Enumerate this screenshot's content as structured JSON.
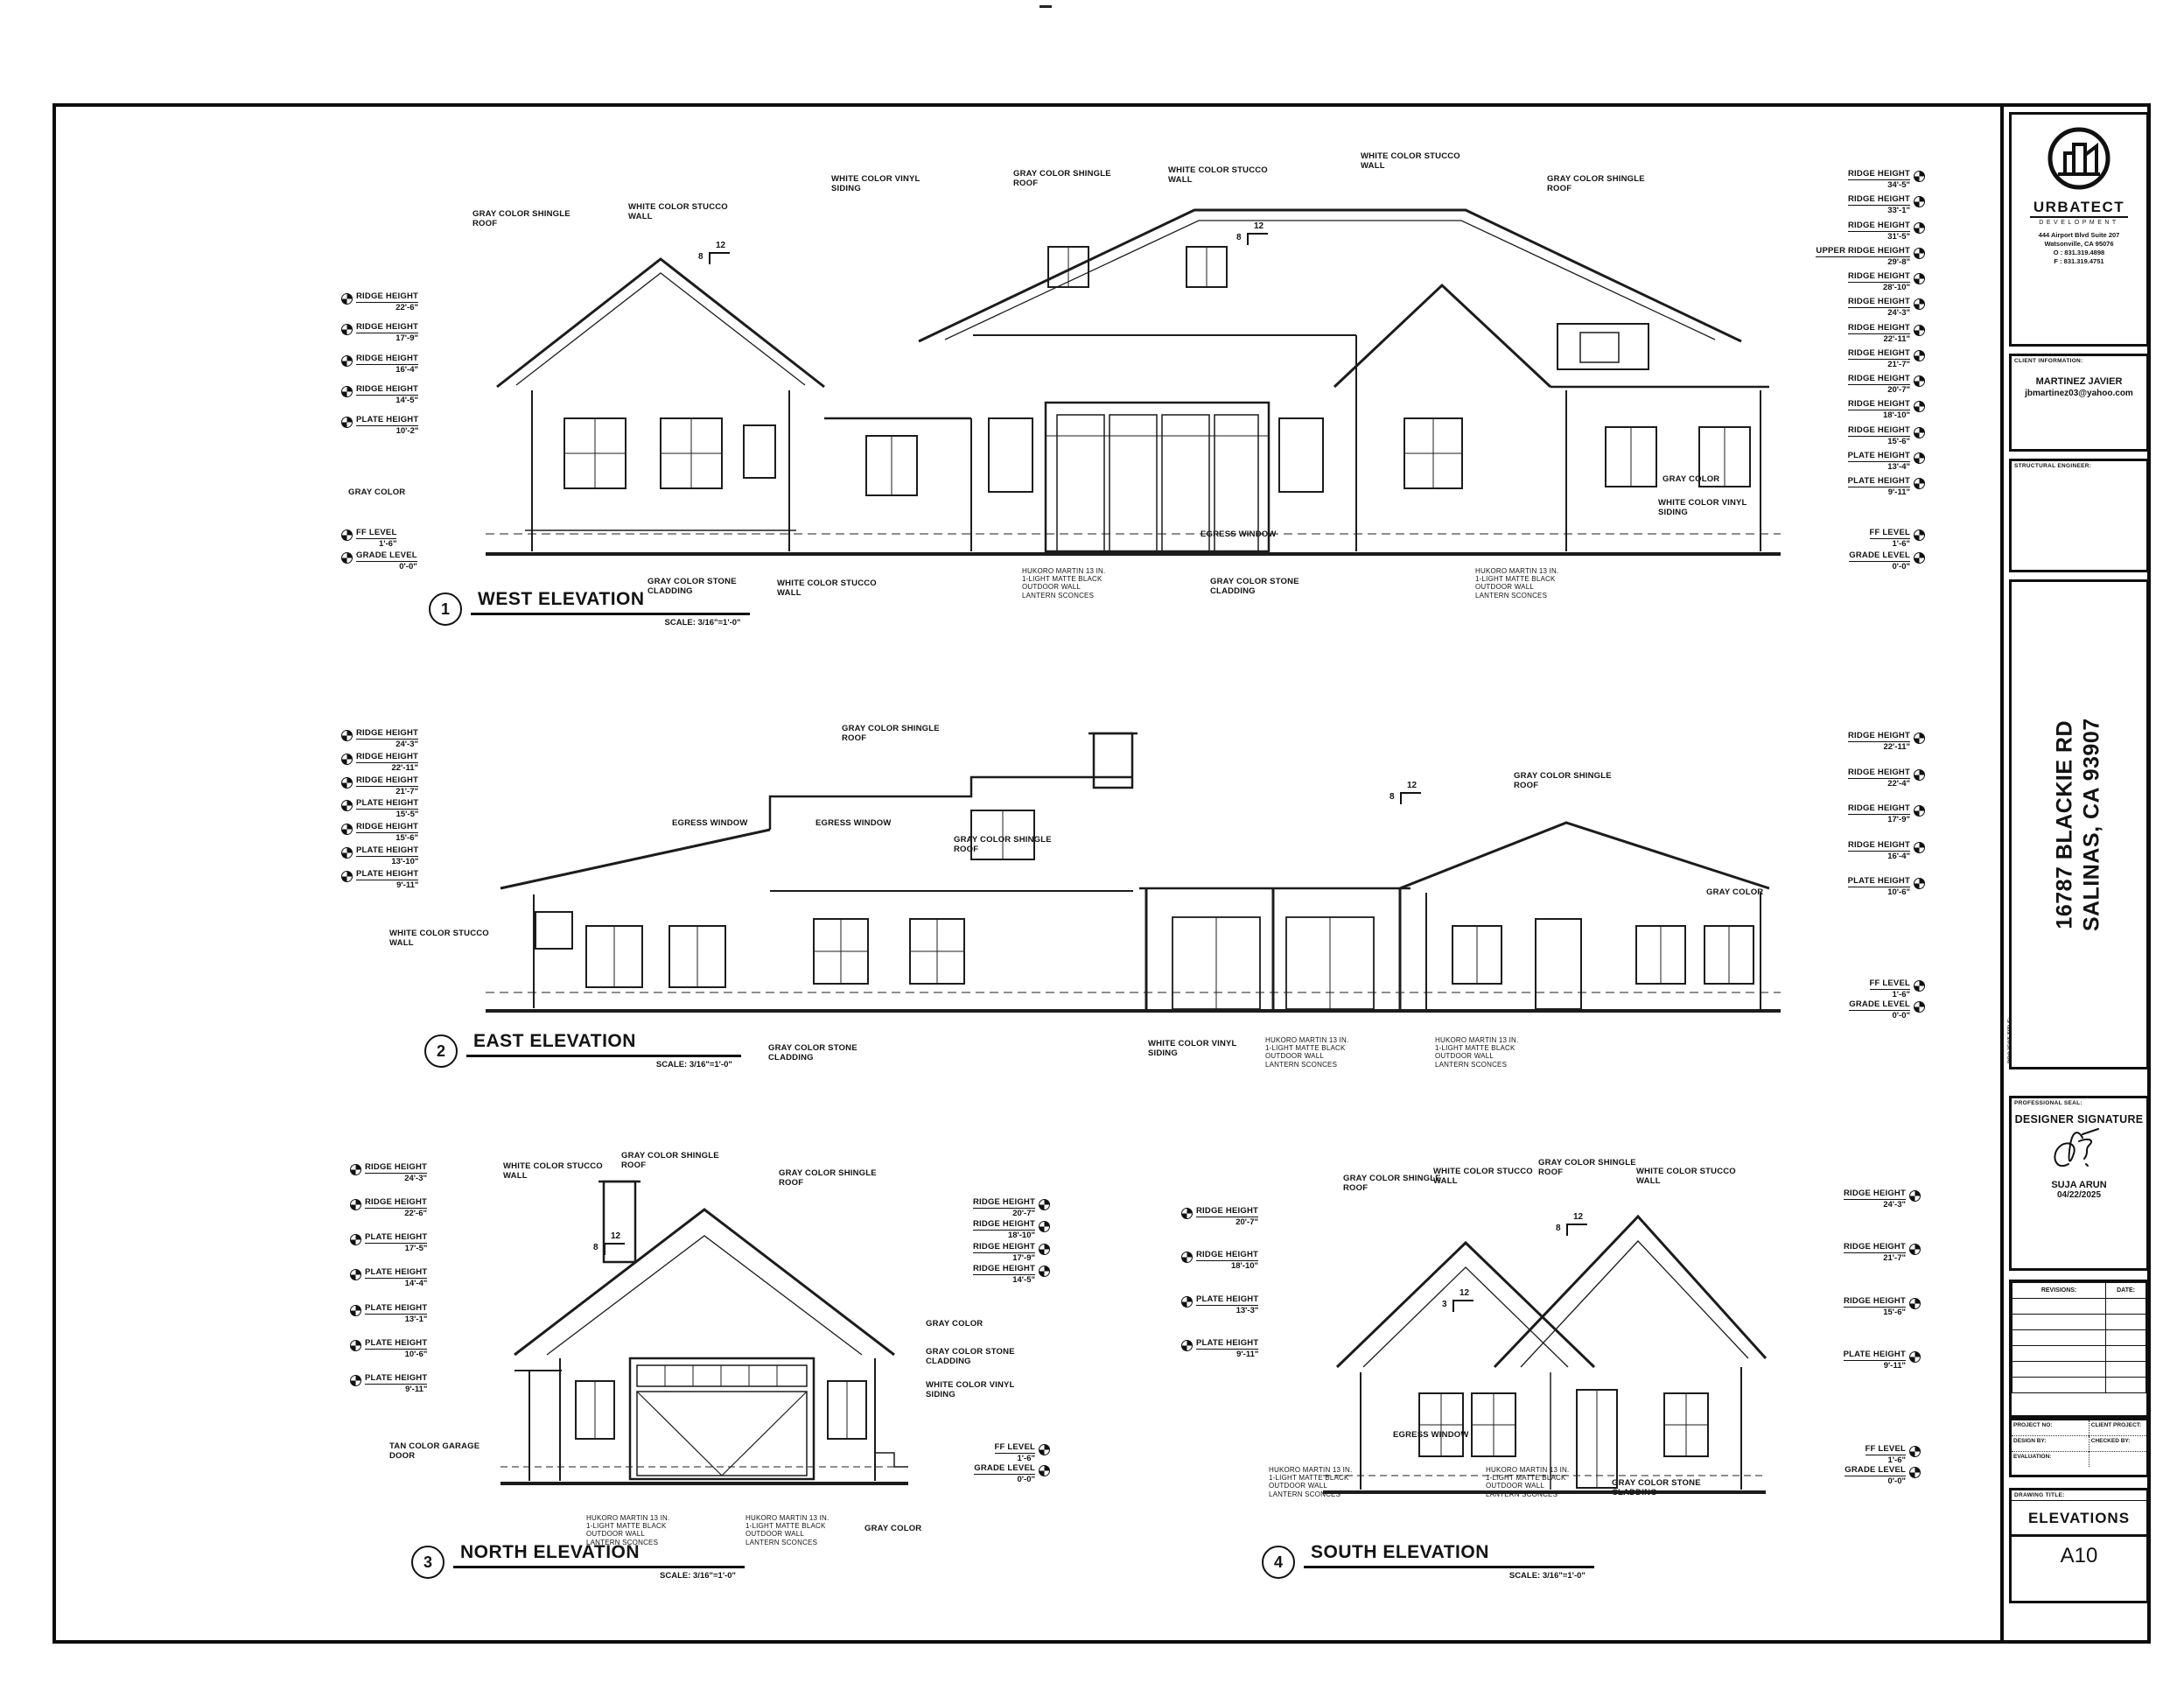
{
  "sheet": {
    "logo": {
      "name": "URBATECT",
      "tagline": "DEVELOPMENT",
      "address1": "444 Airport Blvd Suite 207",
      "address2": "Watsonville, CA 95076",
      "phone_o": "O : 831.319.4898",
      "phone_f": "F : 831.319.4751"
    },
    "client": {
      "section_label": "CLIENT INFORMATION:",
      "name": "MARTINEZ JAVIER",
      "email": "jbmartinez03@yahoo.com"
    },
    "structural": {
      "section_label": "STRUCTURAL ENGINEER:"
    },
    "project": {
      "section_label": "PROJECT TITLE:",
      "address_line1": "16787 BLACKIE RD",
      "address_line2": "SALINAS, CA 93907"
    },
    "seal": {
      "section_label": "PROFESSIONAL SEAL:",
      "title": "DESIGNER SIGNATURE",
      "designer": "SUJA ARUN",
      "date": "04/22/2025"
    },
    "revisions": {
      "col1": "REVISIONS:",
      "col2": "DATE:"
    },
    "info": {
      "project_no_label": "PROJECT NO:",
      "client_project_label": "CLIENT PROJECT:",
      "design_by_label": "DESIGN BY:",
      "checked_by_label": "CHECKED BY:",
      "evaluation_label": "EVALUATION:"
    },
    "drawing": {
      "section_label": "DRAWING TITLE:",
      "title": "ELEVATIONS",
      "sheet_no": "A10"
    }
  },
  "elevations": {
    "west": {
      "number": "1",
      "title": "WEST ELEVATION",
      "scale": "SCALE: 3/16\"=1'-0\"",
      "left_dims": [
        {
          "l": "RIDGE HEIGHT",
          "v": "22'-6\""
        },
        {
          "l": "RIDGE HEIGHT",
          "v": "17'-9\""
        },
        {
          "l": "RIDGE HEIGHT",
          "v": "16'-4\""
        },
        {
          "l": "RIDGE HEIGHT",
          "v": "14'-5\""
        },
        {
          "l": "PLATE HEIGHT",
          "v": "10'-2\""
        }
      ],
      "left_base_dims": [
        {
          "l": "FF LEVEL",
          "v": "1'-6\""
        },
        {
          "l": "GRADE LEVEL",
          "v": "0'-0\""
        }
      ],
      "right_dims": [
        {
          "l": "RIDGE HEIGHT",
          "v": "34'-5\""
        },
        {
          "l": "RIDGE HEIGHT",
          "v": "33'-1\""
        },
        {
          "l": "RIDGE HEIGHT",
          "v": "31'-5\""
        },
        {
          "l": "UPPER RIDGE HEIGHT",
          "v": "29'-8\""
        },
        {
          "l": "RIDGE HEIGHT",
          "v": "28'-10\""
        },
        {
          "l": "RIDGE HEIGHT",
          "v": "24'-3\""
        },
        {
          "l": "RIDGE HEIGHT",
          "v": "22'-11\""
        },
        {
          "l": "RIDGE HEIGHT",
          "v": "21'-7\""
        },
        {
          "l": "RIDGE HEIGHT",
          "v": "20'-7\""
        },
        {
          "l": "RIDGE HEIGHT",
          "v": "18'-10\""
        },
        {
          "l": "RIDGE HEIGHT",
          "v": "15'-6\""
        },
        {
          "l": "PLATE HEIGHT",
          "v": "13'-4\""
        },
        {
          "l": "PLATE HEIGHT",
          "v": "9'-11\""
        }
      ],
      "right_base_dims": [
        {
          "l": "FF LEVEL",
          "v": "1'-6\""
        },
        {
          "l": "GRADE LEVEL",
          "v": "0'-0\""
        }
      ],
      "callouts": [
        "GRAY COLOR SHINGLE ROOF",
        "WHITE COLOR STUCCO WALL",
        "WHITE COLOR VINYL SIDING",
        "GRAY COLOR SHINGLE ROOF",
        "WHITE COLOR STUCCO WALL",
        "WHITE COLOR STUCCO WALL",
        "GRAY COLOR SHINGLE ROOF",
        "GRAY COLOR",
        "WHITE COLOR VINYL SIDING",
        "GRAY COLOR",
        "EGRESS WINDOW",
        "GRAY COLOR STONE CLADDING",
        "WHITE COLOR STUCCO WALL",
        "HUKORO MARTIN 13 IN. 1-LIGHT MATTE BLACK OUTDOOR WALL LANTERN SCONCES",
        "GRAY COLOR STONE CLADDING",
        "HUKORO MARTIN 13 IN. 1-LIGHT MATTE BLACK OUTDOOR WALL LANTERN SCONCES"
      ],
      "pitches": [
        {
          "run": "12",
          "rise": "8"
        },
        {
          "run": "12",
          "rise": "8"
        }
      ]
    },
    "east": {
      "number": "2",
      "title": "EAST ELEVATION",
      "scale": "SCALE: 3/16\"=1'-0\"",
      "left_dims": [
        {
          "l": "RIDGE HEIGHT",
          "v": "24'-3\""
        },
        {
          "l": "RIDGE HEIGHT",
          "v": "22'-11\""
        },
        {
          "l": "RIDGE HEIGHT",
          "v": "21'-7\""
        },
        {
          "l": "PLATE HEIGHT",
          "v": "15'-5\""
        },
        {
          "l": "RIDGE HEIGHT",
          "v": "15'-6\""
        },
        {
          "l": "PLATE HEIGHT",
          "v": "13'-10\""
        },
        {
          "l": "PLATE HEIGHT",
          "v": "9'-11\""
        }
      ],
      "right_dims": [
        {
          "l": "RIDGE HEIGHT",
          "v": "22'-11\""
        },
        {
          "l": "RIDGE HEIGHT",
          "v": "22'-4\""
        },
        {
          "l": "RIDGE HEIGHT",
          "v": "17'-9\""
        },
        {
          "l": "RIDGE HEIGHT",
          "v": "16'-4\""
        },
        {
          "l": "PLATE HEIGHT",
          "v": "10'-6\""
        }
      ],
      "right_base_dims": [
        {
          "l": "FF LEVEL",
          "v": "1'-6\""
        },
        {
          "l": "GRADE LEVEL",
          "v": "0'-0\""
        }
      ],
      "callouts": [
        "GRAY COLOR SHINGLE ROOF",
        "GRAY COLOR SHINGLE ROOF",
        "GRAY COLOR SHINGLE ROOF",
        "WHITE COLOR STUCCO WALL",
        "EGRESS WINDOW",
        "EGRESS WINDOW",
        "GRAY COLOR",
        "GRAY COLOR STONE CLADDING",
        "WHITE COLOR VINYL SIDING",
        "HUKORO MARTIN 13 IN. 1-LIGHT MATTE BLACK OUTDOOR WALL LANTERN SCONCES",
        "HUKORO MARTIN 13 IN. 1-LIGHT MATTE BLACK OUTDOOR WALL LANTERN SCONCES"
      ],
      "pitches": [
        {
          "run": "12",
          "rise": "8"
        }
      ]
    },
    "north": {
      "number": "3",
      "title": "NORTH ELEVATION",
      "scale": "SCALE: 3/16\"=1'-0\"",
      "left_dims": [
        {
          "l": "RIDGE HEIGHT",
          "v": "24'-3\""
        },
        {
          "l": "RIDGE HEIGHT",
          "v": "22'-6\""
        },
        {
          "l": "PLATE HEIGHT",
          "v": "17'-5\""
        },
        {
          "l": "PLATE HEIGHT",
          "v": "14'-4\""
        },
        {
          "l": "PLATE HEIGHT",
          "v": "13'-1\""
        },
        {
          "l": "PLATE HEIGHT",
          "v": "10'-6\""
        },
        {
          "l": "PLATE HEIGHT",
          "v": "9'-11\""
        }
      ],
      "right_dims": [
        {
          "l": "RIDGE HEIGHT",
          "v": "20'-7\""
        },
        {
          "l": "RIDGE HEIGHT",
          "v": "18'-10\""
        },
        {
          "l": "RIDGE HEIGHT",
          "v": "17'-9\""
        },
        {
          "l": "RIDGE HEIGHT",
          "v": "14'-5\""
        }
      ],
      "right_base_dims": [
        {
          "l": "FF LEVEL",
          "v": "1'-6\""
        },
        {
          "l": "GRADE LEVEL",
          "v": "0'-0\""
        }
      ],
      "callouts": [
        "WHITE COLOR STUCCO WALL",
        "GRAY COLOR SHINGLE ROOF",
        "GRAY COLOR SHINGLE ROOF",
        "GRAY COLOR",
        "GRAY COLOR STONE CLADDING",
        "WHITE COLOR VINYL SIDING",
        "TAN COLOR GARAGE DOOR",
        "HUKORO MARTIN 13 IN. 1-LIGHT MATTE BLACK OUTDOOR WALL LANTERN SCONCES",
        "HUKORO MARTIN 13 IN. 1-LIGHT MATTE BLACK OUTDOOR WALL LANTERN SCONCES",
        "GRAY COLOR"
      ],
      "pitches": [
        {
          "run": "12",
          "rise": "8"
        }
      ]
    },
    "south": {
      "number": "4",
      "title": "SOUTH ELEVATION",
      "scale": "SCALE: 3/16\"=1'-0\"",
      "left_dims": [
        {
          "l": "RIDGE HEIGHT",
          "v": "20'-7\""
        },
        {
          "l": "RIDGE HEIGHT",
          "v": "18'-10\""
        },
        {
          "l": "PLATE HEIGHT",
          "v": "13'-3\""
        },
        {
          "l": "PLATE HEIGHT",
          "v": "9'-11\""
        }
      ],
      "right_dims": [
        {
          "l": "RIDGE HEIGHT",
          "v": "24'-3\""
        },
        {
          "l": "RIDGE HEIGHT",
          "v": "21'-7\""
        },
        {
          "l": "RIDGE HEIGHT",
          "v": "15'-6\""
        },
        {
          "l": "PLATE HEIGHT",
          "v": "9'-11\""
        }
      ],
      "right_base_dims": [
        {
          "l": "FF LEVEL",
          "v": "1'-6\""
        },
        {
          "l": "GRADE LEVEL",
          "v": "0'-0\""
        }
      ],
      "callouts": [
        "GRAY COLOR SHINGLE ROOF",
        "WHITE COLOR STUCCO WALL",
        "GRAY COLOR SHINGLE ROOF",
        "WHITE COLOR STUCCO WALL",
        "EGRESS WINDOW",
        "HUKORO MARTIN 13 IN. 1-LIGHT MATTE BLACK OUTDOOR WALL LANTERN SCONCES",
        "HUKORO MARTIN 13 IN. 1-LIGHT MATTE BLACK OUTDOOR WALL LANTERN SCONCES",
        "GRAY COLOR STONE CLADDING"
      ],
      "pitches": [
        {
          "run": "12",
          "rise": "8"
        },
        {
          "run": "12",
          "rise": "3"
        }
      ]
    }
  }
}
